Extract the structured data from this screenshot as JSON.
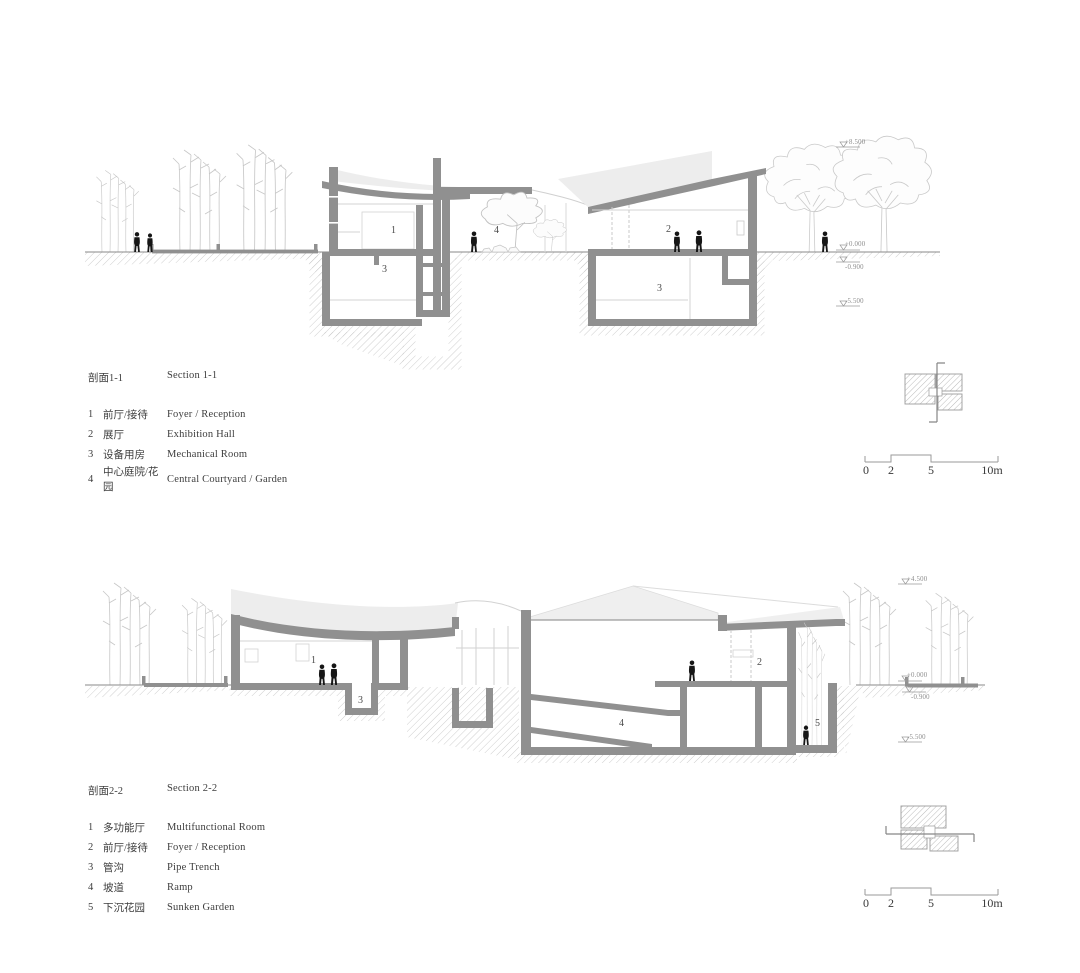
{
  "section1": {
    "title_zh": "剖面1-1",
    "title_en": "Section 1-1",
    "legend": [
      {
        "num": "1",
        "zh": "前厅/接待",
        "en": "Foyer / Reception"
      },
      {
        "num": "2",
        "zh": "展厅",
        "en": "Exhibition Hall"
      },
      {
        "num": "3",
        "zh": "设备用房",
        "en": "Mechanical Room"
      },
      {
        "num": "4",
        "zh": "中心庭院/花园",
        "en": "Central Courtyard / Garden"
      }
    ],
    "room_labels": {
      "foyer": "1",
      "exhibition": "2",
      "mech_a": "3",
      "mech_b": "3",
      "courtyard": "4"
    },
    "elevations": {
      "treetop": "+8.500",
      "ground": "+0.000",
      "below_grade": "-0.900",
      "basement": "-5.500"
    }
  },
  "section2": {
    "title_zh": "剖面2-2",
    "title_en": "Section 2-2",
    "legend": [
      {
        "num": "1",
        "zh": "多功能厅",
        "en": "Multifunctional Room"
      },
      {
        "num": "2",
        "zh": "前厅/接待",
        "en": "Foyer / Reception"
      },
      {
        "num": "3",
        "zh": "管沟",
        "en": "Pipe Trench"
      },
      {
        "num": "4",
        "zh": "坡道",
        "en": "Ramp"
      },
      {
        "num": "5",
        "zh": "下沉花园",
        "en": "Sunken Garden"
      }
    ],
    "room_labels": {
      "multifunctional": "1",
      "foyer": "2",
      "pipe_trench": "3",
      "ramp": "4",
      "sunken_garden": "5"
    },
    "elevations": {
      "treetop": "+4.500",
      "ground": "+0.000",
      "below_grade": "-0.900",
      "basement": "-5.500"
    }
  },
  "scale_bar": {
    "tick_0": "0",
    "tick_2": "2",
    "tick_5": "5",
    "tick_10": "10m"
  }
}
